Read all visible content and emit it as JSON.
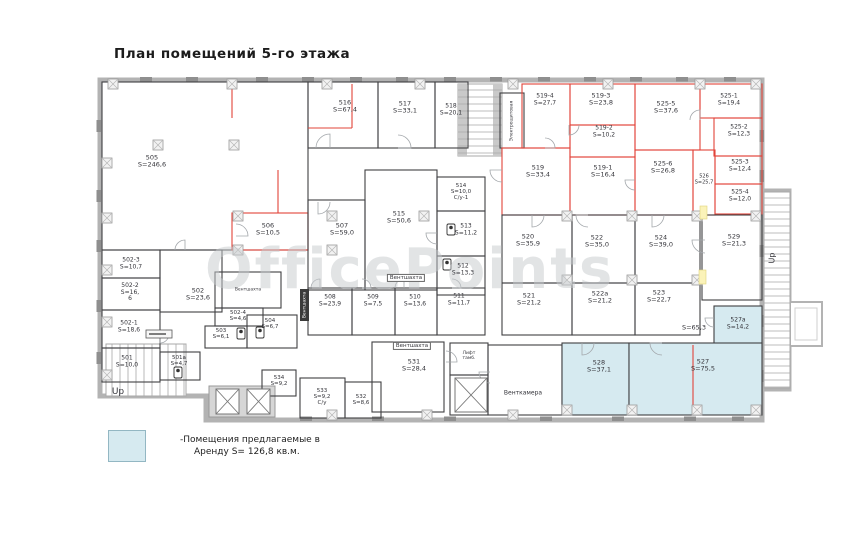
{
  "title": "План помещений  5-го этажа",
  "watermark": "OfficePoints",
  "legend": {
    "swatch_color": "#d6eaf0",
    "line1": "-Помещения предлагаемые в",
    "line2": "Аренду S= 126,8  кв.м."
  },
  "colors": {
    "wall": "#b3b3b3",
    "line": "#3f3f42",
    "red": "#e2443a",
    "blue_fill": "#d6eaf0",
    "yellow": "#fbf3b9"
  },
  "outline": "100,80 762,80 762,420 206,420 206,396 100,396",
  "rooms": [
    {
      "id": "505",
      "lines": [
        "505",
        "S=246,6"
      ],
      "x": 102,
      "y": 82,
      "w": 206,
      "h": 168,
      "s": "b",
      "lx": 152,
      "ly": 162
    },
    {
      "id": "516",
      "lines": [
        "516",
        "S=67,4"
      ],
      "x": 308,
      "y": 82,
      "w": 70,
      "h": 66,
      "s": "b",
      "lx": 345,
      "ly": 107
    },
    {
      "id": "517",
      "lines": [
        "517",
        "S=33,1"
      ],
      "x": 378,
      "y": 82,
      "w": 57,
      "h": 66,
      "s": "b",
      "lx": 405,
      "ly": 108
    },
    {
      "id": "518",
      "lines": [
        "518",
        "S=20,1"
      ],
      "x": 435,
      "y": 82,
      "w": 33,
      "h": 66,
      "s": "b",
      "lx": 451,
      "ly": 110,
      "fs": 6
    },
    {
      "id": "elektro",
      "lines": [],
      "x": 500,
      "y": 93,
      "w": 24,
      "h": 55,
      "s": "b"
    },
    {
      "id": "519-4",
      "lines": [
        "519-4",
        "S=27,7"
      ],
      "x": 522,
      "y": 84,
      "w": 48,
      "h": 64,
      "s": "r",
      "lx": 545,
      "ly": 100,
      "fs": 6
    },
    {
      "id": "519-3",
      "lines": [
        "519-3",
        "S=23,8"
      ],
      "x": 570,
      "y": 84,
      "w": 65,
      "h": 41,
      "s": "r",
      "lx": 601,
      "ly": 100
    },
    {
      "id": "525-5",
      "lines": [
        "525-5",
        "S=37,6"
      ],
      "x": 635,
      "y": 84,
      "w": 65,
      "h": 66,
      "s": "r",
      "lx": 666,
      "ly": 108
    },
    {
      "id": "525-1",
      "lines": [
        "525-1",
        "S=19,4"
      ],
      "x": 700,
      "y": 84,
      "w": 62,
      "h": 34,
      "s": "r",
      "lx": 729,
      "ly": 100,
      "fs": 6
    },
    {
      "id": "525-2",
      "lines": [
        "525-2",
        "S=12,3"
      ],
      "x": 714,
      "y": 118,
      "w": 48,
      "h": 38,
      "s": "r",
      "lx": 739,
      "ly": 131,
      "fs": 6
    },
    {
      "id": "519-2",
      "lines": [
        "519-2",
        "S=10,2"
      ],
      "x": 570,
      "y": 125,
      "w": 65,
      "h": 32,
      "s": "r",
      "lx": 604,
      "ly": 132,
      "fs": 6
    },
    {
      "id": "519-1",
      "lines": [
        "519-1",
        "S=16,4"
      ],
      "x": 570,
      "y": 157,
      "w": 65,
      "h": 58,
      "s": "r",
      "lx": 603,
      "ly": 172
    },
    {
      "id": "525-6",
      "lines": [
        "525-6",
        "S=26,8"
      ],
      "x": 635,
      "y": 150,
      "w": 58,
      "h": 65,
      "s": "r",
      "lx": 663,
      "ly": 168
    },
    {
      "id": "526",
      "lines": [
        "526",
        "S=25,7"
      ],
      "x": 693,
      "y": 150,
      "w": 22,
      "h": 65,
      "s": "r",
      "lx": 704,
      "ly": 180,
      "fs": 5
    },
    {
      "id": "525-3",
      "lines": [
        "525-3",
        "S=12,4"
      ],
      "x": 715,
      "y": 156,
      "w": 47,
      "h": 28,
      "s": "r",
      "lx": 740,
      "ly": 166,
      "fs": 6
    },
    {
      "id": "525-4",
      "lines": [
        "525-4",
        "S=12,0"
      ],
      "x": 715,
      "y": 184,
      "w": 47,
      "h": 30,
      "s": "r",
      "lx": 740,
      "ly": 196,
      "fs": 6
    },
    {
      "id": "519",
      "lines": [
        "519",
        "S=33,4"
      ],
      "x": 502,
      "y": 148,
      "w": 68,
      "h": 67,
      "s": "r",
      "lx": 538,
      "ly": 172
    },
    {
      "id": "514",
      "lines": [
        "514",
        "S=10,0",
        "С/у-1"
      ],
      "x": 437,
      "y": 177,
      "w": 48,
      "h": 34,
      "s": "b",
      "lx": 461,
      "ly": 192,
      "fs": 5.5
    },
    {
      "id": "513",
      "lines": [
        "513",
        "S=11,2"
      ],
      "x": 437,
      "y": 211,
      "w": 48,
      "h": 45,
      "s": "b",
      "lx": 466,
      "ly": 230,
      "fs": 6
    },
    {
      "id": "512",
      "lines": [
        "512",
        "S=13,3"
      ],
      "x": 437,
      "y": 256,
      "w": 48,
      "h": 39,
      "s": "b",
      "lx": 463,
      "ly": 270,
      "fs": 6
    },
    {
      "id": "515",
      "lines": [
        "515",
        "S=50,6"
      ],
      "x": 365,
      "y": 170,
      "w": 72,
      "h": 120,
      "s": "b",
      "lx": 399,
      "ly": 218
    },
    {
      "id": "506",
      "lines": [
        "506",
        "S=10,5"
      ],
      "x": 232,
      "y": 213,
      "w": 76,
      "h": 37,
      "s": "r",
      "lx": 268,
      "ly": 230
    },
    {
      "id": "507",
      "lines": [
        "507",
        "S=59,0"
      ],
      "x": 308,
      "y": 200,
      "w": 57,
      "h": 90,
      "s": "b",
      "lx": 342,
      "ly": 230
    },
    {
      "id": "520",
      "lines": [
        "520",
        "S=35,9"
      ],
      "x": 502,
      "y": 215,
      "w": 70,
      "h": 68,
      "s": "b",
      "lx": 528,
      "ly": 241
    },
    {
      "id": "522",
      "lines": [
        "522",
        "S=35,0"
      ],
      "x": 572,
      "y": 215,
      "w": 63,
      "h": 68,
      "s": "b",
      "lx": 597,
      "ly": 242
    },
    {
      "id": "524",
      "lines": [
        "524",
        "S=39,0"
      ],
      "x": 635,
      "y": 215,
      "w": 65,
      "h": 68,
      "s": "b",
      "lx": 661,
      "ly": 242
    },
    {
      "id": "529",
      "lines": [
        "529",
        "S=21,3"
      ],
      "x": 702,
      "y": 215,
      "w": 60,
      "h": 85,
      "s": "b",
      "lx": 734,
      "ly": 241
    },
    {
      "id": "521",
      "lines": [
        "521",
        "S=21,2"
      ],
      "x": 502,
      "y": 283,
      "w": 70,
      "h": 52,
      "s": "b",
      "lx": 529,
      "ly": 300
    },
    {
      "id": "522а",
      "lines": [
        "522а",
        "S=21,2"
      ],
      "x": 572,
      "y": 283,
      "w": 63,
      "h": 52,
      "s": "b",
      "lx": 600,
      "ly": 298
    },
    {
      "id": "523",
      "lines": [
        "523",
        "S=22,7"
      ],
      "x": 635,
      "y": 283,
      "w": 65,
      "h": 52,
      "s": "b",
      "lx": 659,
      "ly": 297
    },
    {
      "id": "527а",
      "lines": [
        "527а",
        "S=14,2"
      ],
      "x": 714,
      "y": 306,
      "w": 48,
      "h": 44,
      "s": "b",
      "fill": "#d6eaf0",
      "lx": 738,
      "ly": 324,
      "fs": 6
    },
    {
      "id": "508",
      "lines": [
        "508",
        "S=23,9"
      ],
      "x": 308,
      "y": 288,
      "w": 44,
      "h": 47,
      "s": "b",
      "lx": 330,
      "ly": 301,
      "fs": 6
    },
    {
      "id": "509",
      "lines": [
        "509",
        "S=7,5"
      ],
      "x": 352,
      "y": 288,
      "w": 43,
      "h": 47,
      "s": "b",
      "lx": 373,
      "ly": 301,
      "fs": 6
    },
    {
      "id": "510",
      "lines": [
        "510",
        "S=13,6"
      ],
      "x": 395,
      "y": 288,
      "w": 42,
      "h": 47,
      "s": "b",
      "lx": 415,
      "ly": 301,
      "fs": 6
    },
    {
      "id": "511",
      "lines": [
        "511",
        "S=11,7"
      ],
      "x": 437,
      "y": 288,
      "w": 48,
      "h": 47,
      "s": "b",
      "lx": 459,
      "ly": 300,
      "fs": 6
    },
    {
      "id": "502-3",
      "lines": [
        "502-3",
        "S=10,7"
      ],
      "x": 102,
      "y": 250,
      "w": 58,
      "h": 28,
      "s": "b",
      "lx": 131,
      "ly": 264,
      "fs": 6
    },
    {
      "id": "502-2",
      "lines": [
        "502-2",
        "S=16,",
        "6"
      ],
      "x": 102,
      "y": 278,
      "w": 58,
      "h": 32,
      "s": "b",
      "lx": 130,
      "ly": 293,
      "fs": 6
    },
    {
      "id": "502-1",
      "lines": [
        "502-1",
        "S=18,6"
      ],
      "x": 102,
      "y": 310,
      "w": 58,
      "h": 38,
      "s": "b",
      "lx": 129,
      "ly": 327,
      "fs": 6
    },
    {
      "id": "501",
      "lines": [
        "501",
        "S=10,0"
      ],
      "x": 102,
      "y": 348,
      "w": 58,
      "h": 34,
      "s": "b",
      "lx": 127,
      "ly": 362,
      "fs": 6
    },
    {
      "id": "501а",
      "lines": [
        "501а",
        "S=4,7"
      ],
      "x": 160,
      "y": 352,
      "w": 40,
      "h": 28,
      "s": "b",
      "lx": 179,
      "ly": 361,
      "fs": 5.5
    },
    {
      "id": "502",
      "lines": [
        "502",
        "S=23,6"
      ],
      "x": 160,
      "y": 250,
      "w": 62,
      "h": 62,
      "s": "b",
      "lx": 198,
      "ly": 295
    },
    {
      "id": "502-4",
      "lines": [
        "502-4",
        "S=4,6"
      ],
      "x": 215,
      "y": 308,
      "w": 48,
      "h": 18,
      "s": "b",
      "lx": 238,
      "ly": 316,
      "fs": 5.5
    },
    {
      "id": "503",
      "lines": [
        "503",
        "S=6,1"
      ],
      "x": 205,
      "y": 326,
      "w": 42,
      "h": 22,
      "s": "b",
      "lx": 221,
      "ly": 334,
      "fs": 5.5
    },
    {
      "id": "504",
      "lines": [
        "504",
        "S=6,7"
      ],
      "x": 247,
      "y": 315,
      "w": 50,
      "h": 33,
      "s": "b",
      "lx": 270,
      "ly": 324,
      "fs": 5.5
    },
    {
      "id": "vent-trap",
      "lines": [],
      "x": 215,
      "y": 272,
      "w": 66,
      "h": 36,
      "s": "b"
    },
    {
      "id": "531",
      "lines": [
        "531",
        "S=28,4"
      ],
      "x": 372,
      "y": 342,
      "w": 72,
      "h": 70,
      "s": "b",
      "lx": 414,
      "ly": 366
    },
    {
      "id": "534",
      "lines": [
        "534",
        "S=9,2"
      ],
      "x": 262,
      "y": 370,
      "w": 34,
      "h": 26,
      "s": "b",
      "lx": 279,
      "ly": 381,
      "fs": 5.5
    },
    {
      "id": "533",
      "lines": [
        "533",
        "S=9,2",
        "С/у"
      ],
      "x": 300,
      "y": 378,
      "w": 45,
      "h": 40,
      "s": "b",
      "lx": 322,
      "ly": 397,
      "fs": 5.5
    },
    {
      "id": "532",
      "lines": [
        "532",
        "S=8,6"
      ],
      "x": 345,
      "y": 382,
      "w": 36,
      "h": 36,
      "s": "b",
      "lx": 361,
      "ly": 400,
      "fs": 5.5
    },
    {
      "id": "lift-lobby",
      "lines": [],
      "x": 450,
      "y": 343,
      "w": 38,
      "h": 32,
      "s": "b"
    },
    {
      "id": "lift-shaft",
      "lines": [],
      "x": 450,
      "y": 375,
      "w": 38,
      "h": 40,
      "s": "b"
    },
    {
      "id": "ventkamera",
      "lines": [],
      "x": 488,
      "y": 345,
      "w": 74,
      "h": 70,
      "s": "b"
    },
    {
      "id": "528",
      "lines": [
        "528",
        "S=37,1"
      ],
      "x": 562,
      "y": 343,
      "w": 67,
      "h": 72,
      "s": "b",
      "fill": "#d6eaf0",
      "lx": 599,
      "ly": 367
    },
    {
      "id": "527",
      "lines": [
        "527",
        "S=75,5"
      ],
      "x": 629,
      "y": 343,
      "w": 133,
      "h": 72,
      "s": "b",
      "fill": "#d6eaf0",
      "lx": 703,
      "ly": 366
    }
  ],
  "texts": [
    {
      "lines": [
        "Вентшахта"
      ],
      "x": 406,
      "y": 278,
      "size": 5.5,
      "boxed": true,
      "name": "vent-shaft-label"
    },
    {
      "lines": [
        "Вентшахта"
      ],
      "x": 412,
      "y": 346,
      "size": 5.5,
      "boxed": true,
      "name": "vent-shaft-label"
    },
    {
      "lines": [
        "Вентшахта"
      ],
      "x": 304.5,
      "y": 305,
      "size": 4.5,
      "rotate": -90,
      "color": "#ffffff",
      "name": "vent-shaft-label-vertical"
    },
    {
      "lines": [
        "Вентшахта"
      ],
      "x": 248,
      "y": 290,
      "size": 4.5,
      "name": "vent-shaft-label-small"
    },
    {
      "lines": [
        "Электрощитовая"
      ],
      "x": 512,
      "y": 121,
      "size": 4.5,
      "rotate": -90,
      "name": "electrical-room-label"
    },
    {
      "lines": [
        "Венткамера"
      ],
      "x": 523,
      "y": 394,
      "size": 6,
      "name": "vent-chamber-label"
    },
    {
      "lines": [
        "S=65,3"
      ],
      "x": 694,
      "y": 328,
      "size": 6.5,
      "name": "corridor-area-label"
    },
    {
      "lines": [
        "Up"
      ],
      "x": 118,
      "y": 392,
      "size": 9,
      "name": "up-label-left"
    },
    {
      "lines": [
        "Up"
      ],
      "x": 773,
      "y": 258,
      "size": 8,
      "rotate": -90,
      "name": "up-label-right"
    },
    {
      "lines": [
        "Лифт",
        "тамб."
      ],
      "x": 469,
      "y": 356,
      "size": 4.5,
      "name": "lift-lobby-label"
    }
  ],
  "stairs": [
    {
      "x": 458,
      "y": 84,
      "w": 44,
      "h": 72,
      "dir": "v",
      "rails": true
    },
    {
      "x": 764,
      "y": 192,
      "w": 26,
      "h": 196,
      "dir": "v"
    },
    {
      "x": 106,
      "y": 344,
      "w": 80,
      "h": 52,
      "dir": "h"
    }
  ],
  "elevator_block": {
    "x": 209,
    "y": 386,
    "w": 66,
    "h": 31
  },
  "elevators": [
    [
      216,
      389,
      23,
      25
    ],
    [
      247,
      389,
      23,
      25
    ],
    [
      455,
      378,
      32,
      34
    ]
  ],
  "pillars": [
    [
      113,
      84
    ],
    [
      232,
      84
    ],
    [
      327,
      84
    ],
    [
      420,
      84
    ],
    [
      513,
      84
    ],
    [
      608,
      84
    ],
    [
      700,
      84
    ],
    [
      756,
      84
    ],
    [
      158,
      145
    ],
    [
      234,
      145
    ],
    [
      107,
      163
    ],
    [
      107,
      218
    ],
    [
      107,
      270
    ],
    [
      107,
      322
    ],
    [
      107,
      375
    ],
    [
      238,
      216
    ],
    [
      332,
      216
    ],
    [
      424,
      216
    ],
    [
      567,
      216
    ],
    [
      632,
      216
    ],
    [
      697,
      216
    ],
    [
      756,
      216
    ],
    [
      238,
      250
    ],
    [
      332,
      250
    ],
    [
      567,
      280
    ],
    [
      632,
      280
    ],
    [
      697,
      280
    ],
    [
      567,
      410
    ],
    [
      632,
      410
    ],
    [
      697,
      410
    ],
    [
      756,
      410
    ],
    [
      332,
      415
    ],
    [
      427,
      415
    ],
    [
      513,
      415
    ]
  ],
  "dashes": {
    "top": [
      140,
      186,
      256,
      302,
      350,
      396,
      444,
      490,
      538,
      584,
      630,
      676,
      724
    ],
    "bottom": [
      300,
      372,
      444,
      540,
      612,
      684,
      732
    ],
    "left": [
      120,
      190,
      240,
      300,
      352
    ],
    "right": [
      130,
      170,
      245,
      315,
      370
    ]
  },
  "red_lines": [
    [
      352,
      84,
      352,
      128
    ],
    [
      308,
      128,
      352,
      128
    ],
    [
      232,
      84,
      232,
      118
    ],
    [
      278,
      170,
      278,
      213
    ],
    [
      693,
      345,
      693,
      413
    ]
  ],
  "yellow_marks": [
    {
      "x": 700,
      "y": 206,
      "w": 7,
      "h": 13
    },
    {
      "x": 699,
      "y": 270,
      "w": 7,
      "h": 14
    }
  ],
  "arcs": [
    [
      330,
      148,
      14,
      180
    ],
    [
      398,
      148,
      13,
      270
    ],
    [
      236,
      236,
      12,
      270
    ],
    [
      318,
      202,
      12,
      0
    ],
    [
      502,
      170,
      12,
      90
    ],
    [
      532,
      215,
      12,
      0
    ],
    [
      588,
      215,
      12,
      90
    ],
    [
      652,
      215,
      12,
      0
    ],
    [
      705,
      240,
      13,
      90
    ],
    [
      582,
      343,
      12,
      0
    ],
    [
      662,
      343,
      12,
      90
    ],
    [
      320,
      288,
      9,
      180
    ],
    [
      362,
      288,
      9,
      270
    ],
    [
      404,
      288,
      9,
      180
    ],
    [
      452,
      288,
      9,
      270
    ],
    [
      437,
      233,
      11,
      90
    ],
    [
      446,
      362,
      11,
      270
    ],
    [
      490,
      372,
      11,
      90
    ],
    [
      160,
      334,
      9,
      0
    ],
    [
      185,
      250,
      10,
      180
    ],
    [
      714,
      318,
      9,
      90
    ],
    [
      569,
      125,
      10,
      0
    ],
    [
      635,
      180,
      10,
      90
    ],
    [
      700,
      120,
      10,
      180
    ],
    [
      545,
      148,
      10,
      270
    ]
  ],
  "wc_icons": [
    [
      447,
      224
    ],
    [
      443,
      259
    ],
    [
      237,
      328
    ],
    [
      256,
      327
    ],
    [
      174,
      367
    ]
  ]
}
